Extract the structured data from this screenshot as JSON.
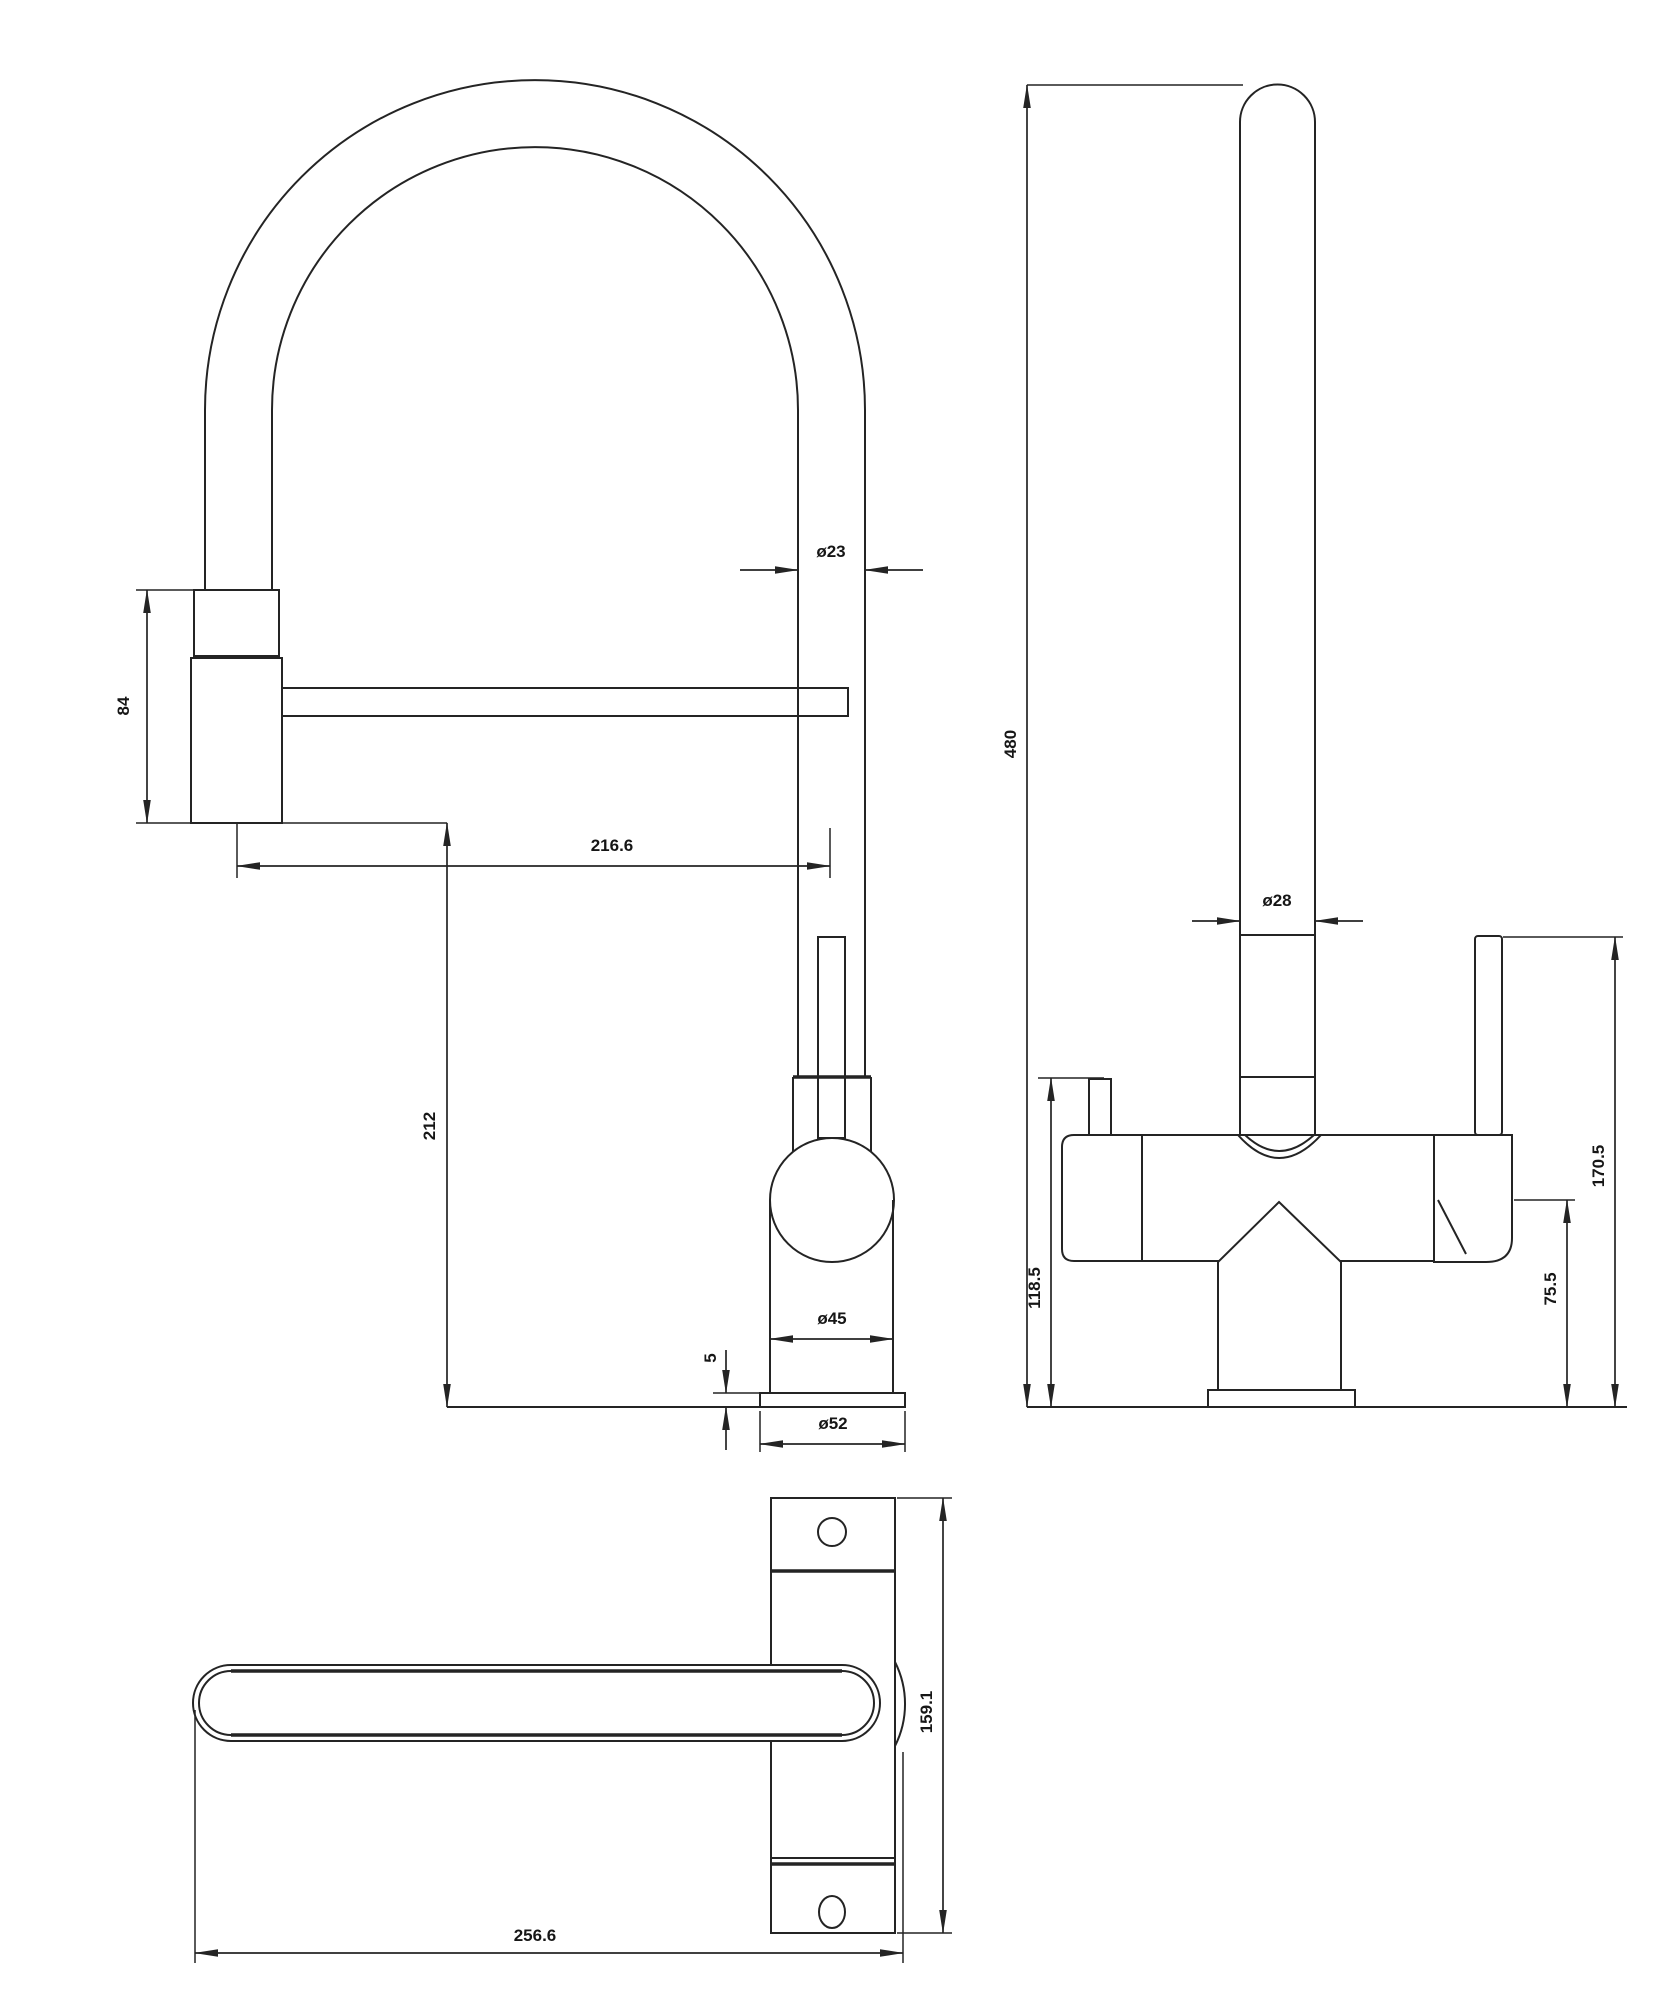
{
  "drawing": {
    "line_color": "#242424",
    "background": "#ffffff",
    "dimensions": {
      "front": {
        "spout_tube_diameter": "ø23",
        "spray_head_height": "84",
        "spout_reach": "216.6",
        "outlet_height": "212",
        "body_diameter": "ø45",
        "base_plate_thickness": "5",
        "base_plate_diameter": "ø52"
      },
      "side": {
        "overall_height": "480",
        "riser_diameter": "ø28",
        "body_height": "118.5",
        "handle_hub_height": "75.5",
        "lever_height": "170.5"
      },
      "top": {
        "depth": "159.1",
        "width": "256.6"
      }
    }
  }
}
